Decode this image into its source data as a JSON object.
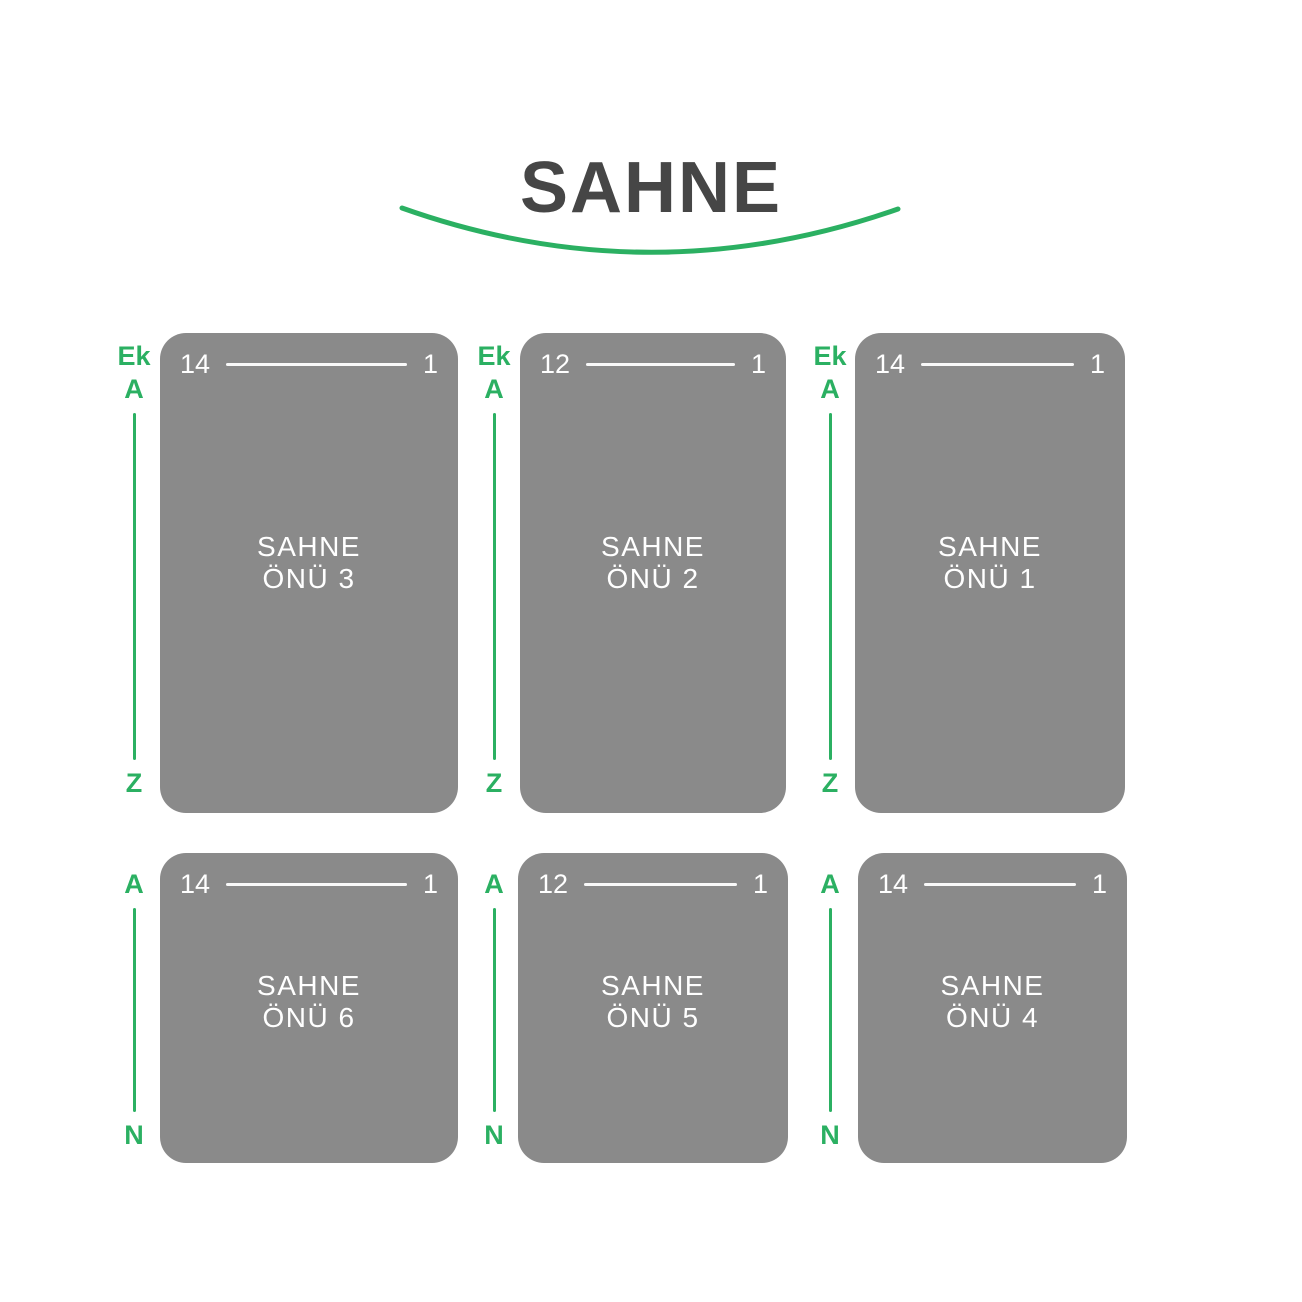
{
  "stage": {
    "title": "SAHNE"
  },
  "colors": {
    "accent_green": "#2bb062",
    "block_gray": "#8a8a8a",
    "title_gray": "#464646",
    "block_text": "#ffffff"
  },
  "blocks": [
    {
      "name": "SAHNE ÖNÜ 3",
      "name_line1": "SAHNE",
      "name_line2": "ÖNÜ 3",
      "seat_left": "14",
      "seat_right": "1",
      "rows": {
        "extra": "Ek",
        "first": "A",
        "last": "Z"
      }
    },
    {
      "name": "SAHNE ÖNÜ 2",
      "name_line1": "SAHNE",
      "name_line2": "ÖNÜ 2",
      "seat_left": "12",
      "seat_right": "1",
      "rows": {
        "extra": "Ek",
        "first": "A",
        "last": "Z"
      }
    },
    {
      "name": "SAHNE ÖNÜ 1",
      "name_line1": "SAHNE",
      "name_line2": "ÖNÜ 1",
      "seat_left": "14",
      "seat_right": "1",
      "rows": {
        "extra": "Ek",
        "first": "A",
        "last": "Z"
      }
    },
    {
      "name": "SAHNE ÖNÜ 6",
      "name_line1": "SAHNE",
      "name_line2": "ÖNÜ 6",
      "seat_left": "14",
      "seat_right": "1",
      "rows": {
        "first": "A",
        "last": "N"
      }
    },
    {
      "name": "SAHNE ÖNÜ 5",
      "name_line1": "SAHNE",
      "name_line2": "ÖNÜ 5",
      "seat_left": "12",
      "seat_right": "1",
      "rows": {
        "first": "A",
        "last": "N"
      }
    },
    {
      "name": "SAHNE ÖNÜ 4",
      "name_line1": "SAHNE",
      "name_line2": "ÖNÜ 4",
      "seat_left": "14",
      "seat_right": "1",
      "rows": {
        "first": "A",
        "last": "N"
      }
    }
  ]
}
